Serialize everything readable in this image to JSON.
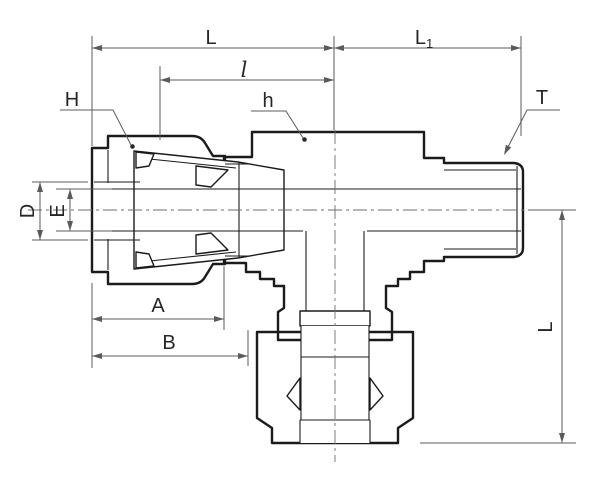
{
  "drawing": {
    "kind": "technical-drawing",
    "subject": "compression tube fitting male run tee cross-section",
    "background": "#ffffff",
    "colors": {
      "outline": "#1b1b1b",
      "dimension_lines": "#5b5b5b",
      "label_text": "#262626",
      "body_fill": "#e8e9ea",
      "body_dot": "#c6c9cb",
      "nut_fill": "#ced1d3",
      "nut_dot": "#a4a8ab"
    },
    "labels": {
      "L_top": "L",
      "L1_main": "L",
      "L1_sub": "1",
      "l_inner": "l",
      "H": "H",
      "h": "h",
      "T": "T",
      "D": "D",
      "E": "E",
      "A": "A",
      "B": "B",
      "L_vertical": "L"
    }
  }
}
